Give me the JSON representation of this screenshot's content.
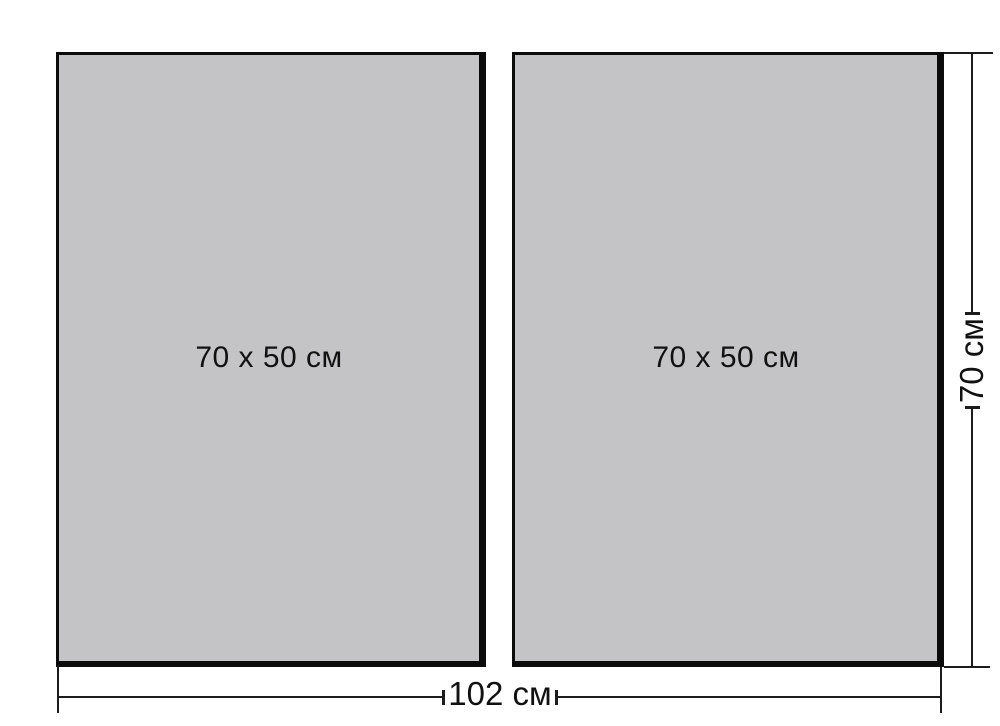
{
  "diagram": {
    "description": "Two-panel wall canvas set dimension drawing",
    "panels": [
      {
        "label": "70 x 50 см"
      },
      {
        "label": "70 x 50 см"
      }
    ],
    "dimensions": {
      "total_width_label": "102 см",
      "total_height_label": "70 см"
    },
    "colors": {
      "panel_fill": "#c4c4c6",
      "panel_border": "#0b0b0b",
      "line": "#1c1c1c",
      "background": "#ffffff"
    }
  }
}
